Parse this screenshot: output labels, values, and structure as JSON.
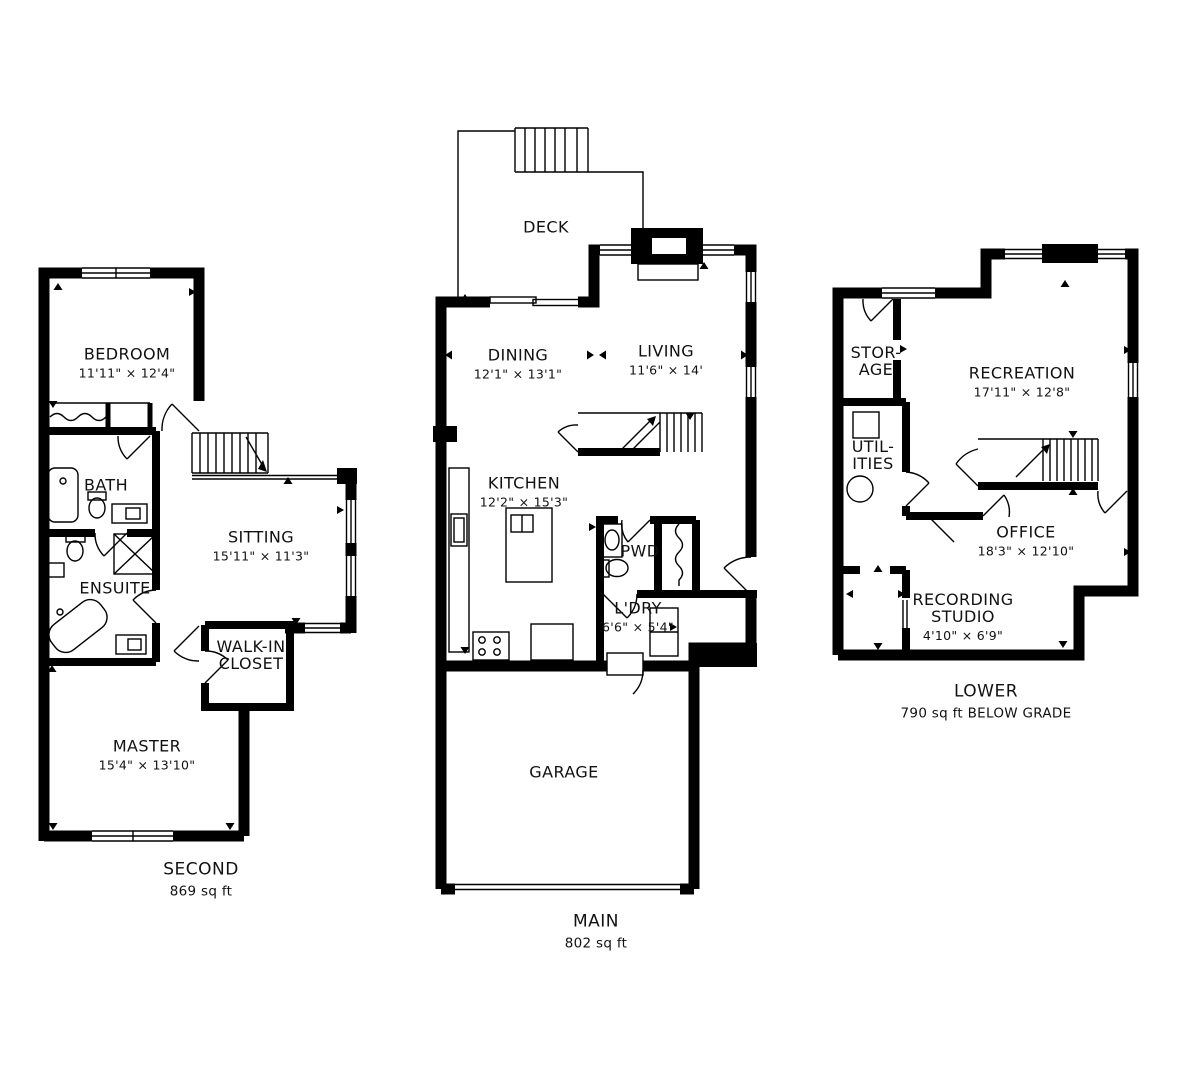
{
  "page": {
    "background": "#ffffff",
    "ink": "#000000"
  },
  "plans": {
    "second": {
      "floor_label": "SECOND",
      "area_label": "869 sq ft",
      "rooms": {
        "bedroom": {
          "name": "BEDROOM",
          "dims": "11'11\" × 12'4\""
        },
        "bath": {
          "name": "BATH"
        },
        "sitting": {
          "name": "SITTING",
          "dims": "15'11\" × 11'3\""
        },
        "ensuite": {
          "name": "ENSUITE"
        },
        "walk_in_closet": {
          "name": "WALK-IN\nCLOSET"
        },
        "master": {
          "name": "MASTER",
          "dims": "15'4\" × 13'10\""
        }
      }
    },
    "main": {
      "floor_label": "MAIN",
      "area_label": "802 sq ft",
      "rooms": {
        "deck": {
          "name": "DECK"
        },
        "dining": {
          "name": "DINING",
          "dims": "12'1\" × 13'1\""
        },
        "living": {
          "name": "LIVING",
          "dims": "11'6\" × 14'"
        },
        "kitchen": {
          "name": "KITCHEN",
          "dims": "12'2\" × 15'3\""
        },
        "pwd": {
          "name": "PWD"
        },
        "laundry": {
          "name": "L'DRY",
          "dims": "6'6\" × 5'4\""
        },
        "garage": {
          "name": "GARAGE"
        }
      }
    },
    "lower": {
      "floor_label": "LOWER",
      "area_label": "790 sq ft BELOW GRADE",
      "rooms": {
        "storage": {
          "name": "STOR-\nAGE"
        },
        "recreation": {
          "name": "RECREATION",
          "dims": "17'11\" × 12'8\""
        },
        "utilities": {
          "name": "UTIL-\nITIES"
        },
        "office": {
          "name": "OFFICE",
          "dims": "18'3\" × 12'10\""
        },
        "recording_studio": {
          "name": "RECORDING\nSTUDIO",
          "dims": "4'10\" × 6'9\""
        }
      }
    }
  }
}
